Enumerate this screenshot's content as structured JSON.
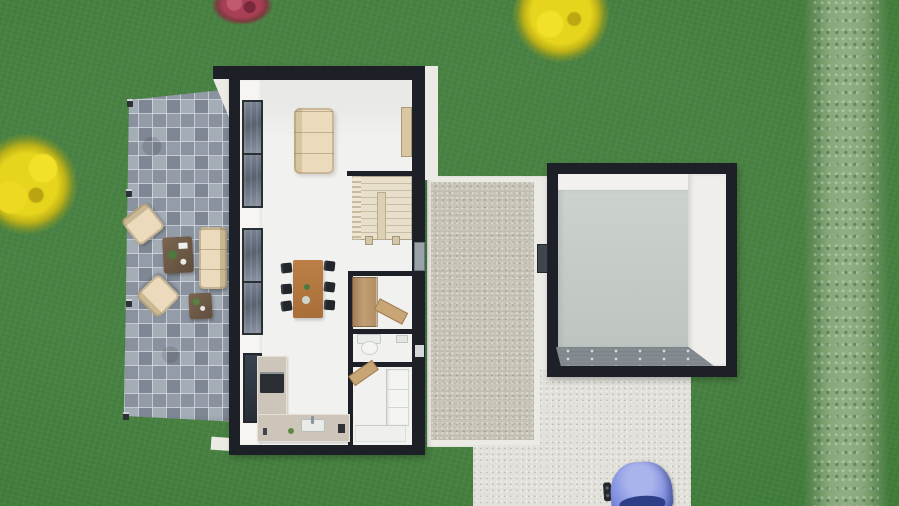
{
  "scene": {
    "view": "top-down 3D floor-plan render of a house and garden",
    "garden": {
      "lawn": "grass",
      "hedge": "tall hedge along right edge",
      "plants": [
        "yellow tree left",
        "yellow tree top",
        "red bush top"
      ]
    },
    "patio": {
      "surface": "grey square pavers",
      "lamp_count": 4,
      "furniture": [
        "armchair",
        "armchair",
        "outdoor sofa",
        "coffee table",
        "side table"
      ]
    },
    "house": {
      "walls": "black",
      "floor": "white",
      "rooms": [
        "living room",
        "dining area",
        "kitchen",
        "stair hall",
        "closet",
        "wc",
        "bathroom"
      ],
      "furniture": [
        "sofa",
        "sideboard",
        "winder staircase",
        "dining table",
        "6 dining chairs",
        "L-shaped kitchen counter",
        "oven",
        "sink",
        "wardrobe",
        "wood bench",
        "toilet",
        "vanity cabinet",
        "shower",
        "wall windows x5",
        "side door"
      ]
    },
    "courtyard": {
      "surface": "gravel strip between house and garage",
      "doors": 2
    },
    "garage": {
      "walls": "black",
      "floor": "grey",
      "feature": "garage-door mat at bottom"
    },
    "driveway": {
      "surface": "speckled concrete",
      "vehicle": "blue car (partially cropped)"
    }
  },
  "colors": {
    "grass": "#3f7c39",
    "hedge": "#87a87a",
    "tree_yellow": "#e6d41d",
    "bush_red": "#a83f54",
    "paver_a": "#939ca8",
    "paver_b": "#7e8793",
    "paver_c": "#a4acb6",
    "paver_d": "#89929e",
    "gravel": "#c8c4b7",
    "concrete": "#e2e0da",
    "wall": "#1d2127",
    "floor": "#f1f1ef",
    "white_ext": "#eceae5",
    "beige": "#ebdbbc",
    "stair": "#e9e0cb",
    "counter": "#cdc4ba",
    "garage_floor": "#c6ccc7",
    "garage_mat": "#7f868c",
    "car": "#8392e1"
  }
}
